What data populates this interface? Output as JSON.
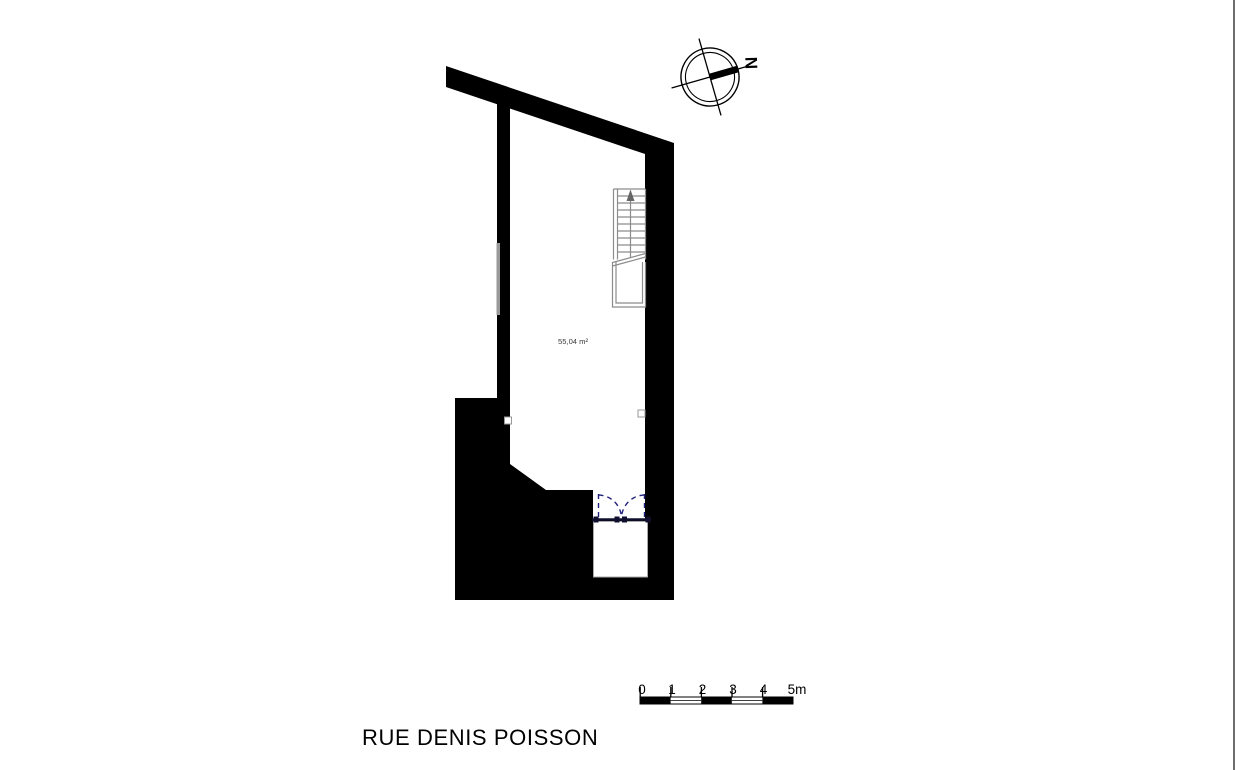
{
  "plan": {
    "area_label": "55,04 m²",
    "street_label": "RUE DENIS POISSON"
  },
  "north_arrow": {
    "letter": "N"
  },
  "scale_bar": {
    "labels": [
      "0",
      "1",
      "2",
      "3",
      "4",
      "5m"
    ],
    "unit": "m",
    "meters_total": 5
  },
  "colors": {
    "wall": "#000000",
    "door_swing": "#22227a",
    "stair_lines": "#8c8c8c",
    "area_text": "#3a3a3a",
    "label_text": "#000000",
    "screen_edge": "#6d6d6d"
  }
}
